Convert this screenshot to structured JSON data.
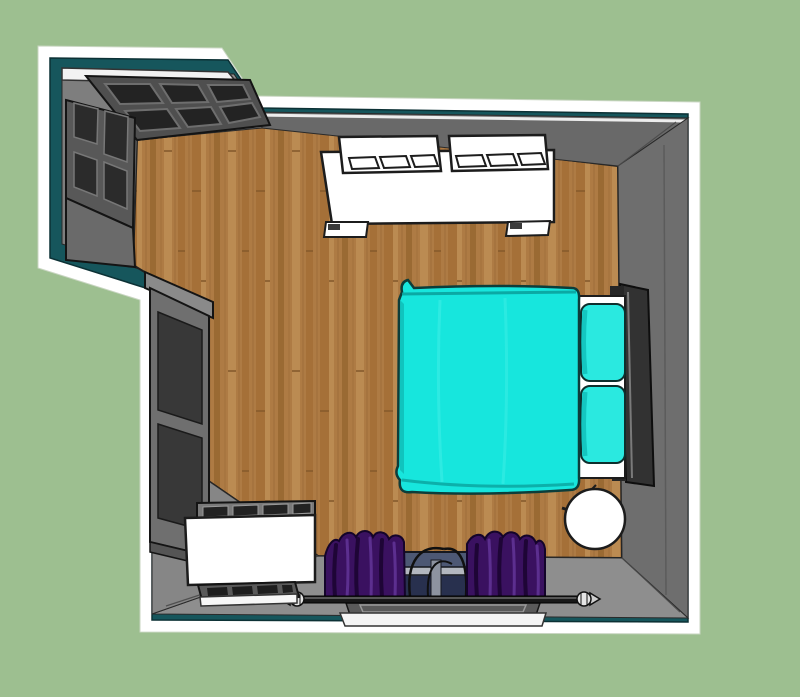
{
  "scene": {
    "title": "bedroom-floor-plan-3d-render",
    "view": "top-down-3d",
    "room": {
      "type": "bedroom",
      "shape": "L-shaped with closet alcove at top-left",
      "floor": "hardwood planks",
      "walls": "gray interior faces with teal painted top edge and white cut trim"
    },
    "objects": [
      {
        "id": "closet-doors",
        "label": "dark paneled closet doors in top-left alcove"
      },
      {
        "id": "armoire",
        "label": "dark armoire left side of alcove"
      },
      {
        "id": "tall-wardrobe",
        "label": "tall dark wardrobe along left wall"
      },
      {
        "id": "sofa",
        "label": "white two-cushion sofa against top wall"
      },
      {
        "id": "bed",
        "label": "bed with turquoise spread and two turquoise pillows"
      },
      {
        "id": "headboard",
        "label": "dark headboard against right wall"
      },
      {
        "id": "nightstand",
        "label": "round white bedside table bottom-right"
      },
      {
        "id": "dresser",
        "label": "white dresser bottom-left"
      },
      {
        "id": "floor-grille",
        "label": "slatted grille tray in front of dresser"
      },
      {
        "id": "window",
        "label": "window in bottom wall with blue glass"
      },
      {
        "id": "curtains",
        "label": "purple curtains on black rod with finials"
      }
    ]
  },
  "palette": {
    "background_green": "#9dbf90",
    "trim_white": "#ffffff",
    "wall_top_teal": "#16565c",
    "wall_face_gray": "#8c8c8c",
    "wall_face_top": "#696969",
    "wall_face_right": "#6e6e6e",
    "wall_face_bottom": "#8e8e8e",
    "wall_face_alcove": "#7e7e7e",
    "outline_black": "#1c1c1c",
    "wood_base": "#ae7b44",
    "wood_dark": "#9a6a33",
    "wood_mid": "#a57038",
    "wood_light": "#bb8b52",
    "bed_spread": "#17e6dd",
    "bed_pillow": "#2ae9e0",
    "bed_shade": "#0fbdb8",
    "bed_frame": "#323232",
    "sofa_white": "#ffffff",
    "wardrobe_frame": "#6f6f6f",
    "wardrobe_panel": "#383838",
    "closet_panel": "#232323",
    "closet_face": "#4f4f4f",
    "dresser_white": "#ffffff",
    "curtain_purple": "#3a1160",
    "curtain_dark": "#1e0536",
    "curtain_light": "#5c2f8f",
    "window_glass": "#4d5874",
    "window_glass_dark": "#28304e",
    "window_sash": "#b3b7bf",
    "rod_black": "#181818",
    "table_white": "#ffffff"
  }
}
